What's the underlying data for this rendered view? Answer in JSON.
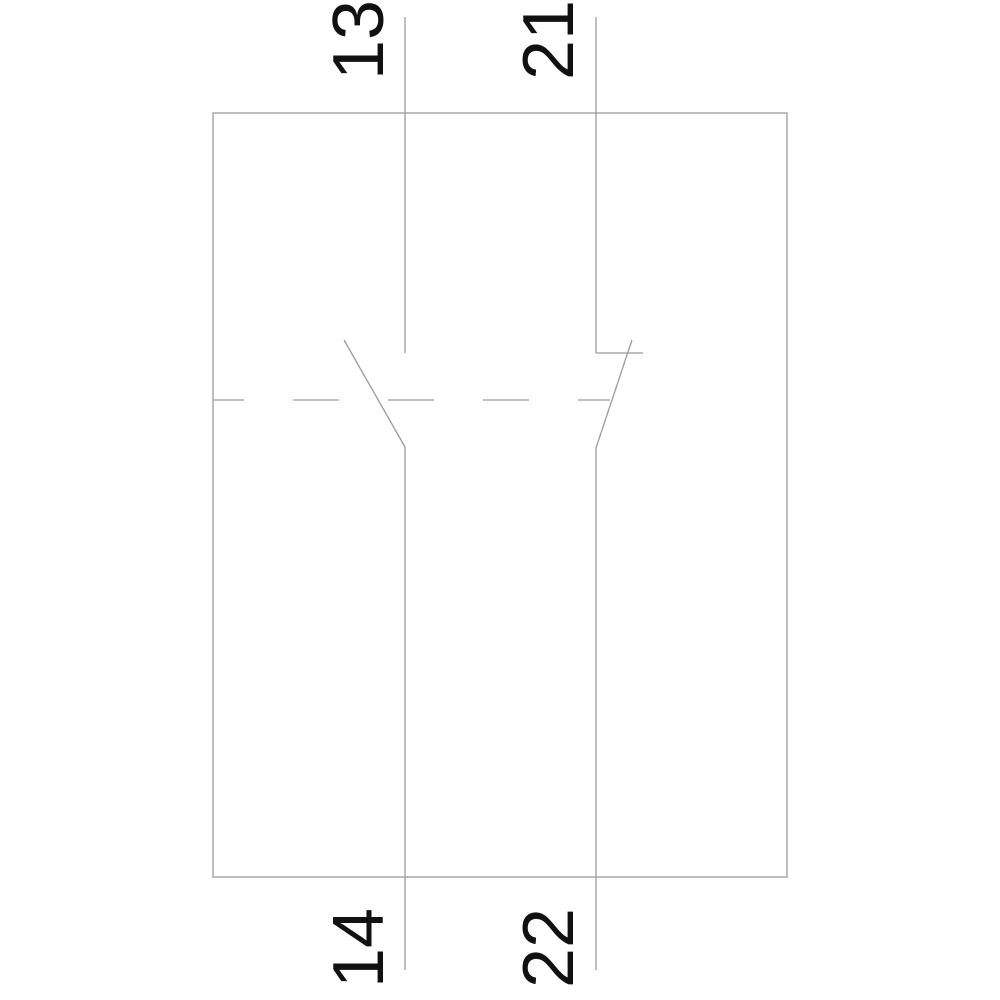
{
  "diagram": {
    "kind": "electrical-schematic",
    "description": "Auxiliary contact block circuit diagram with one normally-open contact and one normally-closed contact linked by a dashed mechanical actuation line",
    "colors": {
      "background": "#ffffff",
      "line": "#9b9b9b",
      "label": "#111111"
    },
    "terminals": {
      "top_left": "13",
      "top_right": "21",
      "bottom_left": "14",
      "bottom_right": "22"
    },
    "contacts": [
      {
        "type": "normally-open",
        "terminal_pair": "13-14"
      },
      {
        "type": "normally-closed",
        "terminal_pair": "21-22"
      }
    ]
  }
}
